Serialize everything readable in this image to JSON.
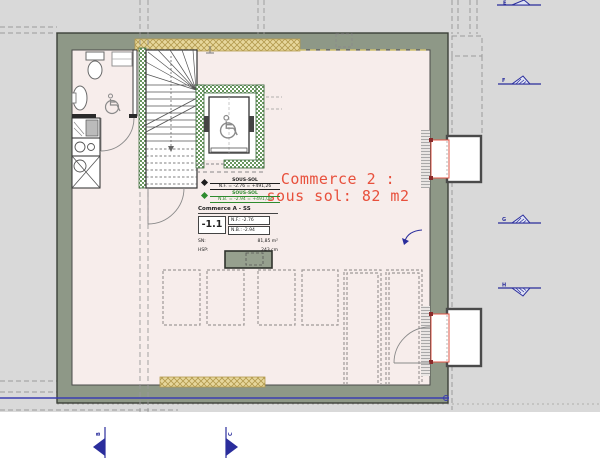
{
  "drawing": {
    "room_label": {
      "line1": "Commerce 2 :",
      "line2": "sous sol: 82 m2"
    },
    "benchmarks": {
      "nf": {
        "title": "SOUS-SOL",
        "value": "N.F. = -2.76 = +491,26"
      },
      "nb": {
        "title": "SOUS-SOL",
        "value": "N.B. = -2.94 = +491,08"
      }
    },
    "info_box": {
      "title": "Commerce A - SS",
      "level": "-1.1",
      "nf": "N.F.: -2.76",
      "nb": "N.B.: -2.94",
      "sn_label": "SN:",
      "sn_value": "81,85 m²",
      "hsp_label": "HSP:",
      "hsp_value": "243 cm"
    },
    "grid_markers": {
      "right": [
        {
          "label": "E"
        },
        {
          "label": "F"
        },
        {
          "label": "G"
        },
        {
          "label": "H"
        }
      ],
      "bottom": [
        {
          "label": "B"
        },
        {
          "label": "C"
        }
      ]
    },
    "icons": {
      "wheelchair": "wheelchair-accessibility-icon",
      "benchmark": "level-benchmark-icon",
      "section_marker": "section-cut-marker-icon"
    },
    "colors": {
      "background": "#d9d9d9",
      "wall": "#8e9887",
      "floor": "#f7edeb",
      "hatch_green": "#69975f",
      "insulation_tan": "#e7d79c",
      "label_red": "#e8503c",
      "marker_navy": "#2a2d9c",
      "annotation_green": "#2e8b2e",
      "boundary_blue": "#3a3db0",
      "opening_red": "#e05545"
    }
  }
}
